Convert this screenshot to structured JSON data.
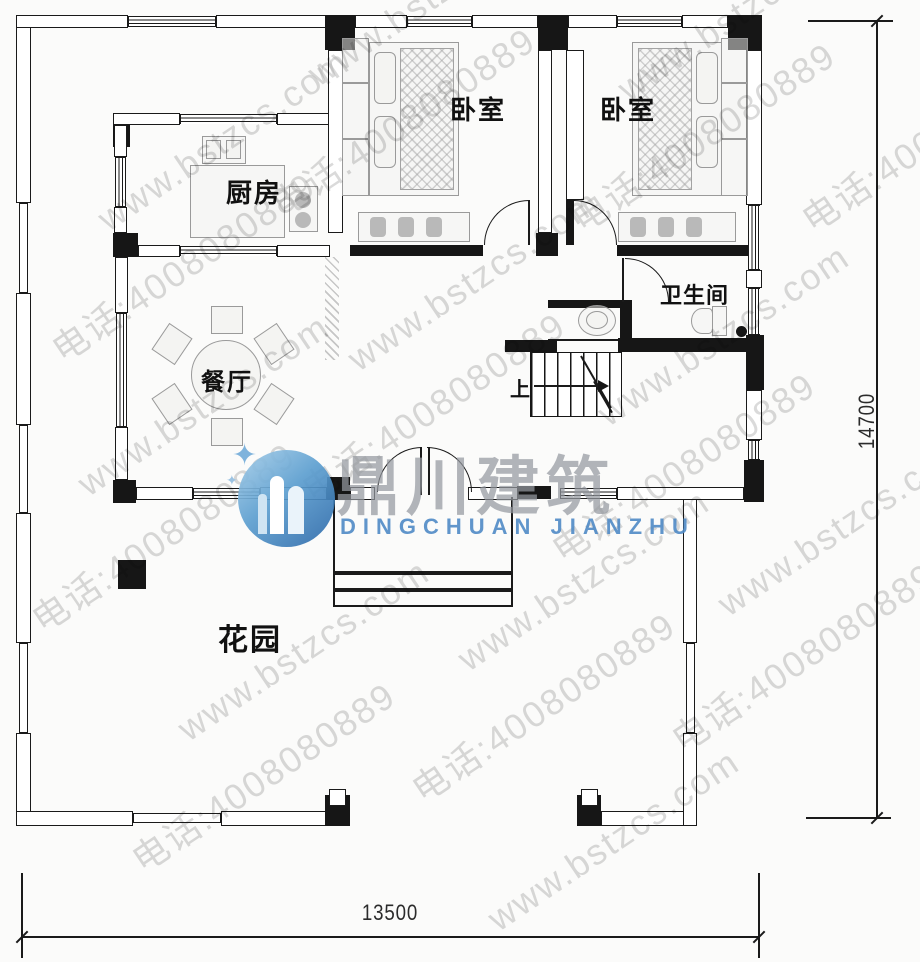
{
  "labels": {
    "kitchen": "厨房",
    "bedroom_left": "卧室",
    "bedroom_right": "卧室",
    "bathroom": "卫生间",
    "dining": "餐厅",
    "garden": "花园",
    "stairs_up": "上"
  },
  "dimensions": {
    "width_label": "13500",
    "height_label": "14700"
  },
  "watermark": {
    "site": "www.bstzcs.com",
    "phone": "电话:4008080889"
  },
  "logo": {
    "cn": "鼎川建筑",
    "en": "DINGCHUAN JIANZHU"
  },
  "colors": {
    "line": "#1a1a1a",
    "furniture": "#9a9a9a",
    "watermark": "#acacac",
    "logo_blue": "#3f7fbd",
    "logo_gray": "#9498a0",
    "background": "#fbfbfa"
  }
}
